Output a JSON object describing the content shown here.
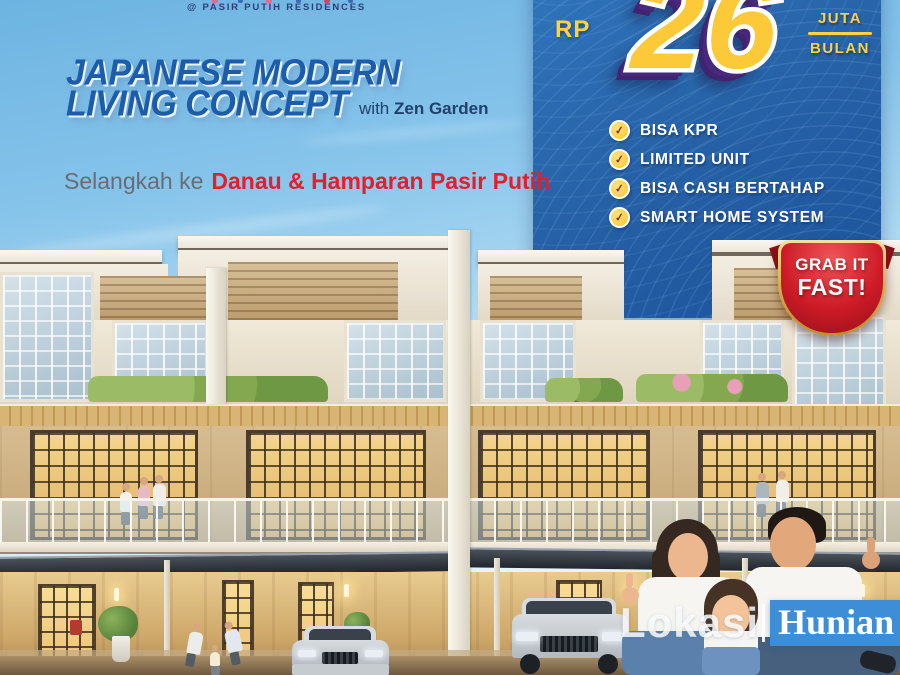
{
  "header": {
    "brand_small": "@ PASIR PUTIH RESIDENCES"
  },
  "headline": {
    "line1": "JAPANESE MODERN",
    "line2": "LIVING CONCEPT",
    "with_prefix": "with",
    "with_name": "Zen Garden"
  },
  "tagline": {
    "prefix": "Selangkah ke",
    "highlight": "Danau & Hamparan Pasir Putih"
  },
  "price_panel": {
    "currency": "RP",
    "amount": "26",
    "per_top": "JUTA",
    "per_bottom": "BULAN",
    "check_glyph": "✓",
    "features": [
      {
        "label": "BISA KPR"
      },
      {
        "label": "LIMITED UNIT"
      },
      {
        "label": "BISA CASH BERTAHAP"
      },
      {
        "label": "SMART HOME SYSTEM"
      }
    ]
  },
  "badge": {
    "line1": "GRAB IT",
    "line2": "FAST!"
  },
  "watermark": {
    "left": "Lokasi",
    "right": "Hunian"
  },
  "colors": {
    "headline_blue": "#1c5caa",
    "tagline_red": "#e41e2c",
    "panel_blue": "#255fa5",
    "accent_yellow": "#ffd23f",
    "amount_purple": "#46287c",
    "badge_red": "#cd1b27",
    "badge_gold": "#dcae52",
    "watermark_blue": "#3e8ed7"
  }
}
